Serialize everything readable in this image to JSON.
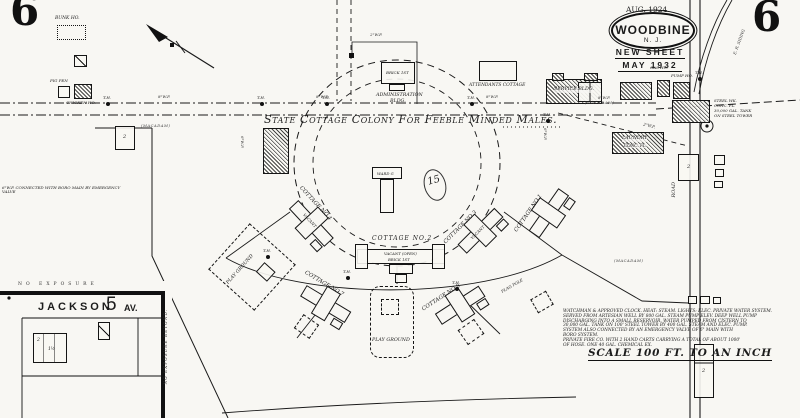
{
  "map_title": "Sanborn insurance map sheet, Woodbine N.J.",
  "colors": {
    "paper": "#f8f7f3",
    "ink": "#1a1a1a"
  },
  "texts": {
    "sheet_no": "6",
    "survey_date": "AUG. 1924",
    "city": "WOODBINE",
    "state": "N. J.",
    "new_sheet": "NEW SHEET",
    "new_sheet_date": "MAY 1932",
    "colony_title": "State Cottage Colony For Feeble Minded Males.",
    "block_no": "15",
    "admin_l1": "ADMINISTRATION",
    "admin_l2": "BLDG.",
    "brick_1st": "BRICK 1ST",
    "attendants": "ATTENDANTS COTTAGE",
    "service": "SERVICE BLDG.",
    "laundry_l1": "LAUNDRY",
    "laundry_l2": "CONC. FL.",
    "gas_ho": "GAS HO.",
    "pump_ho": "PUMP HO.",
    "steel_l1": "STEEL WK.",
    "steel_l2": "CONC. FL.",
    "steel_l3": "30,000 GAL. TANK",
    "steel_l4": "ON STEEL TOWER",
    "ward": "WARD G",
    "bunk_ho": "BUNK HO.",
    "pig_pen": "PIG PEN",
    "chicken_ho": "CHICKEN HO.",
    "vacant": "VACANT",
    "open_note": "(OPEN)",
    "play_ground": "PLAY GROUND",
    "flag_pole": "FLAG POLE",
    "macadam": "(MACADAM)",
    "road": "ROAD",
    "er_siding": "E. R. SIDING",
    "wp8": "8\"W.P.",
    "wp6": "6\"W.P.",
    "wp2": "2\"W.P.",
    "th": "T.H.",
    "connection_note": "6\"W.P. CONNECTED WITH BORO MAIN BY EMERGENCY VALVE",
    "jackson": "JACKSON",
    "av_number": "5",
    "av": "AV.",
    "no_exposure": "NO EXPOSURE",
    "no_exposure_beyond": "NO EXPOSURE BEYOND.",
    "scale": "SCALE 100 FT. TO AN INCH",
    "story2": "2",
    "story15": "1½"
  },
  "cottages": [
    {
      "label": "COTTAGE NO.1"
    },
    {
      "label": "COTTAGE NO.2"
    },
    {
      "label": "COTTAGE NO.3"
    },
    {
      "label": "COTTAGE NO.4"
    },
    {
      "label": "COTTAGE NO.7"
    },
    {
      "label": "COTTAGE NO.8"
    }
  ],
  "notes": [
    "WATCHMAN & APPROVED CLOCK. HEAT: STEAM. LIGHTS: ELEC. PRIVATE WATER SYSTEM.",
    "SERVED FROM ARTESIAN WELL BY 800 GAL. STEAM PUMP ELEV. DEEP WELL PUMP",
    "DISCHARGING INTO A SMALL RESERVOIR. WATER PUMPED FROM CISTERN TO",
    "30,000 GAL. TANK ON 100' STEEL TOWER BY 400 GAL. STEAM AND ELEC. PUMP.",
    "SYSTEM ALSO CONNECTED BY AN EMERGENCY VALVE OF 6\" MAIN WITH",
    "BORO SYSTEM.",
    "PRIVATE FIRE CO. WITH 2 HAND CARTS CARRYING A TOTAL OF ABOUT 1000'",
    "OF HOSE. ONE 40 GAL. CHEMICAL EX."
  ]
}
